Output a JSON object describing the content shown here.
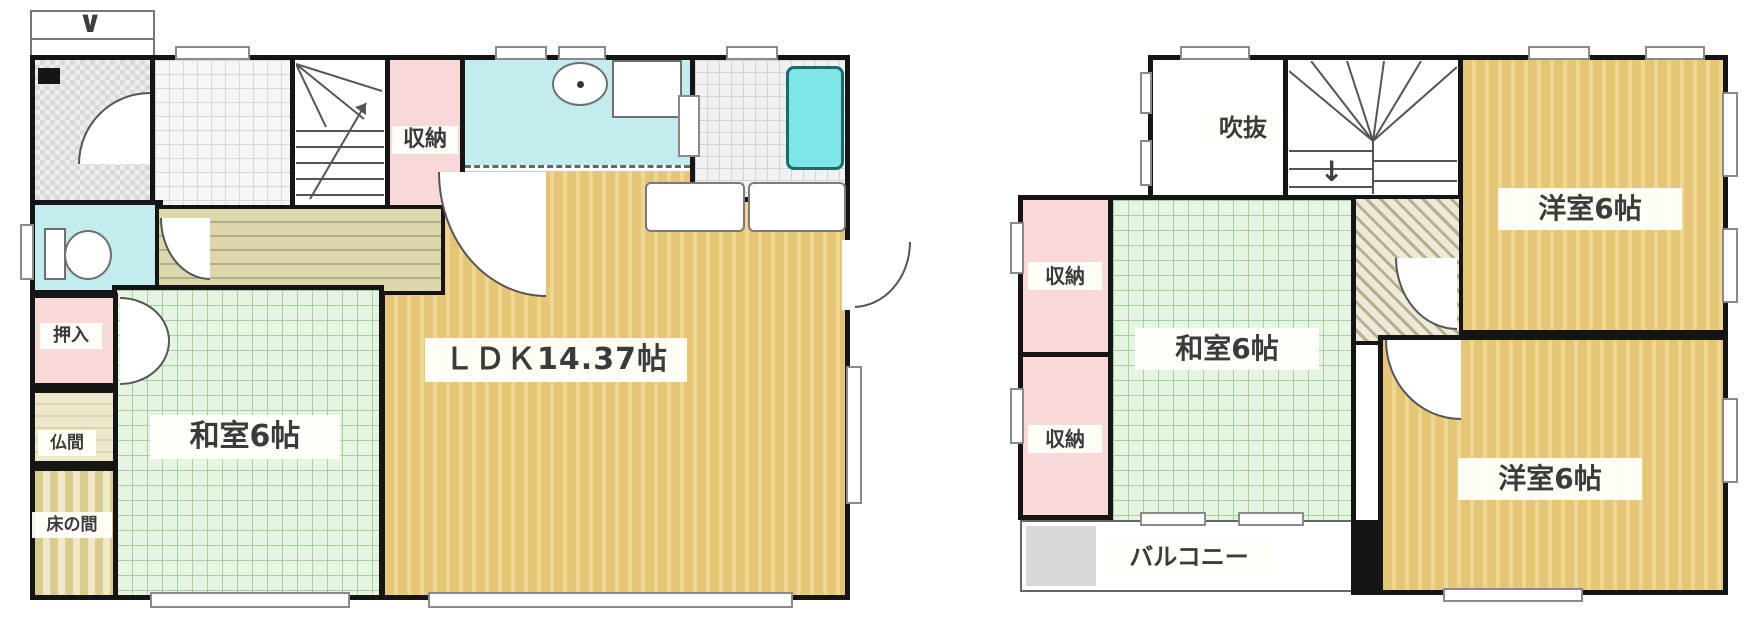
{
  "floor1": {
    "rooms": {
      "storage": "収納",
      "ldk": "ＬＤＫ14.37帖",
      "washitsu": "和室6帖",
      "oshiire": "押入",
      "butsuma": "仏間",
      "tokonoma": "床の間"
    }
  },
  "floor2": {
    "rooms": {
      "void": "吹抜",
      "western_top": "洋室6帖",
      "storage_upper": "収納",
      "storage_lower": "収納",
      "washitsu": "和室6帖",
      "western_bottom": "洋室6帖",
      "balcony": "バルコニー"
    }
  },
  "symbols": {
    "entry_arrow": "∨",
    "stairs_down_arrow": "↓"
  },
  "colors": {
    "wall": "#151515",
    "tatami_green": "#e6f4e2",
    "wood_tan": "#e5c676",
    "closet_pink": "#f8d8d8",
    "water_cyan": "#c2ecee",
    "tub_cyan": "#7ee6e6",
    "balcony_gray": "#d8d8d8"
  }
}
